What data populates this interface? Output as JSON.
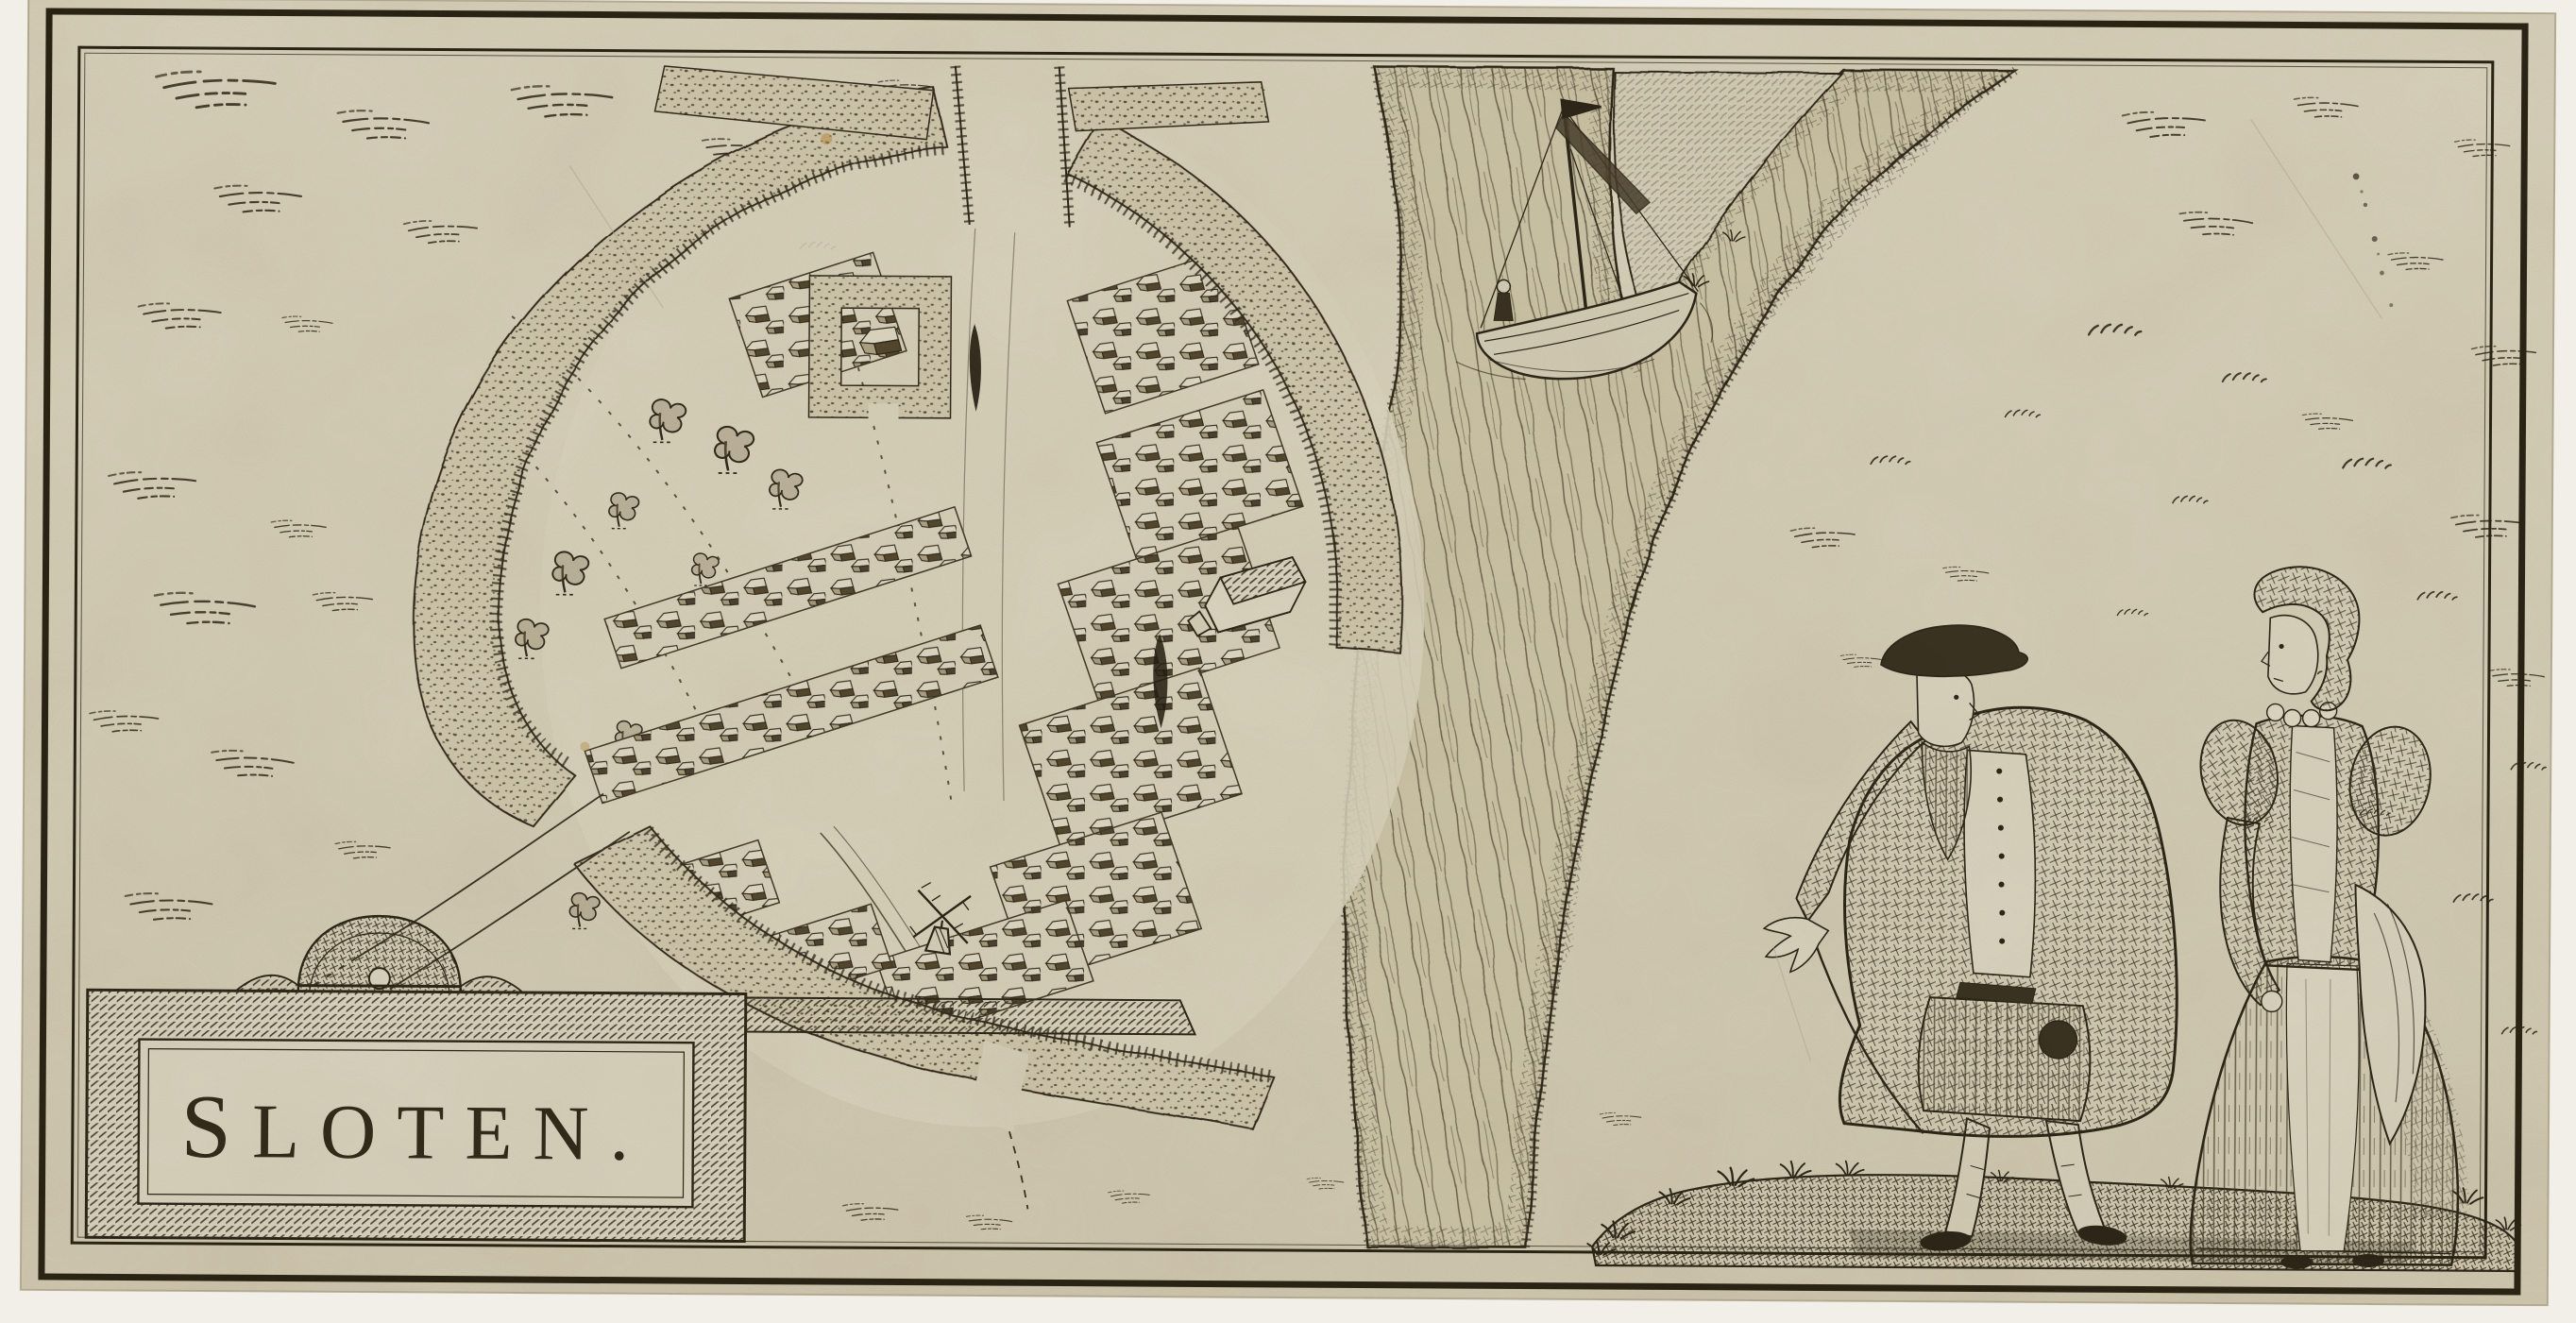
{
  "artwork": {
    "cartouche_title": "SLOTEN.",
    "colors": {
      "paper": "#d8d1bc",
      "margin": "#f1efe8",
      "ink": "#2e2718",
      "paper_dark": "#cfc7ab",
      "panel": "#dcd6c2"
    }
  }
}
